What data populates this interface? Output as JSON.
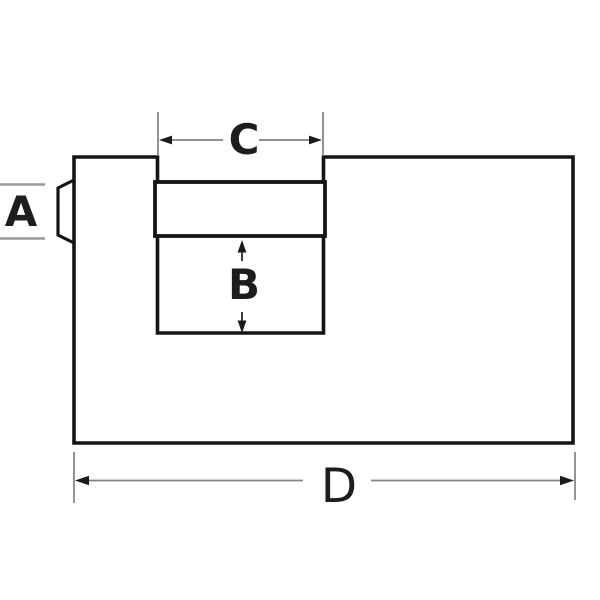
{
  "diagram": {
    "labels": {
      "a": "A",
      "b": "B",
      "c": "C",
      "d": "D"
    },
    "colors": {
      "background": "#ffffff",
      "outline": "#151515",
      "dimension_line": "#828282",
      "dimension_line_light": "#9a9a9a",
      "arrow": "#1a1a1a",
      "label_text": "#1d1d1d"
    }
  }
}
